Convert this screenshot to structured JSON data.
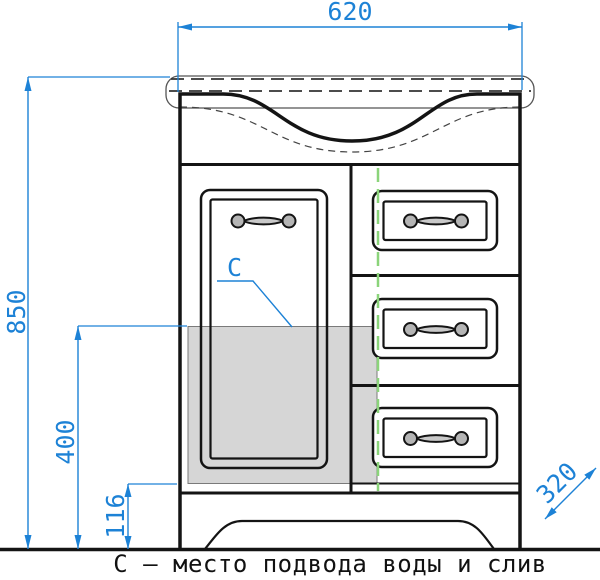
{
  "drawing": {
    "type": "furniture technical drawing, front view of bathroom vanity cabinet with sink",
    "dimensions": {
      "width_mm": "620",
      "height_mm": "850",
      "zone_top_mm": "400",
      "zone_bottom_mm": "116",
      "depth_mm": "320"
    },
    "labels": {
      "zone_marker": "С",
      "caption": "С – место подвода воды и слив"
    },
    "colors": {
      "dimension_blue": "#1d82d6",
      "centerline_green": "#8bd47a",
      "zone_gray": "#d6d6d6",
      "zone_gray_border": "#7a7a7a",
      "line_black": "#141414",
      "thin_gray": "#444444",
      "handle_fill": "#b5b5b5"
    }
  }
}
